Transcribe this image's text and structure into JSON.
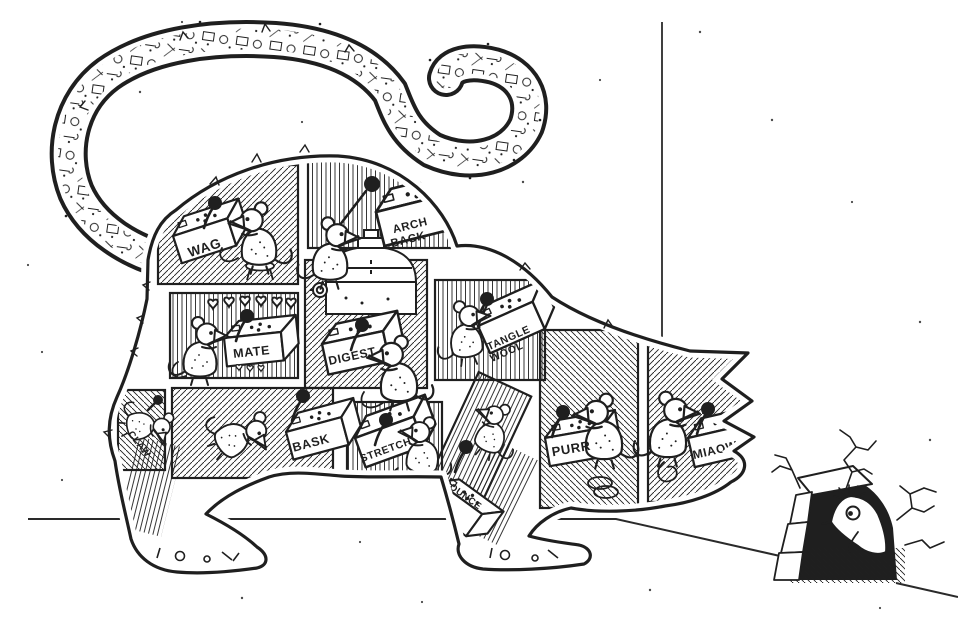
{
  "scene": {
    "title": "How a cat works",
    "description": "Black-ink cartoon of a crouching cat stalking a mouse hole in a room corner. The cat's body and head are divided into machine control rooms, each operated by a mouse pulling a ball-topped joystick. The curled tail is a tube full of mechanical doodles. A spooked mouse peeks from a cracked mouse hole at lower right.",
    "ink_color": "#1f1f1f",
    "paper_color": "#ffffff",
    "room_count": 11,
    "operator_mice_count": 11,
    "peeking_mice_count": 1
  },
  "rooms": [
    {
      "id": "wag",
      "label": "WAG",
      "lines": [
        "WAG"
      ]
    },
    {
      "id": "arch-back",
      "label": "ARCH BACK",
      "lines": [
        "ARCH",
        "BACK"
      ]
    },
    {
      "id": "mate",
      "label": "MATE",
      "lines": [
        "MATE"
      ]
    },
    {
      "id": "digest",
      "label": "DIGEST",
      "lines": [
        "DIGEST"
      ]
    },
    {
      "id": "tangle-wool",
      "label": "TANGLE WOOL",
      "lines": [
        "TANGLE",
        "WOOL"
      ]
    },
    {
      "id": "claw",
      "label": "CLAW",
      "lines": [
        "CLAW"
      ]
    },
    {
      "id": "bask",
      "label": "BASK",
      "lines": [
        "BASK"
      ]
    },
    {
      "id": "stretch",
      "label": "STRETCH",
      "lines": [
        "STRETCH"
      ]
    },
    {
      "id": "pounce",
      "label": "POUNCE",
      "lines": [
        "POUNCE"
      ]
    },
    {
      "id": "purr",
      "label": "PURR",
      "lines": [
        "PURR"
      ]
    },
    {
      "id": "miaow",
      "label": "MIAOW",
      "lines": [
        "MIAOW"
      ]
    }
  ]
}
